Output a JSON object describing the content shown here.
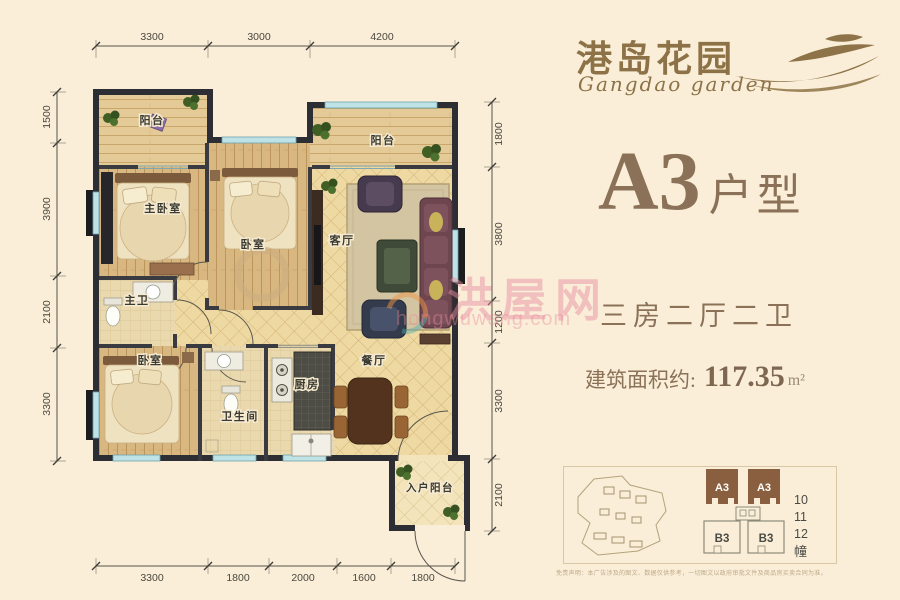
{
  "logo": {
    "cn": "港岛花园",
    "en": "Gangdao garden"
  },
  "unit": {
    "code": "A3",
    "type_suffix": "户型",
    "rooms_desc": "三房二厅二卫",
    "area_label": "建筑面积约:",
    "area_value": "117.35",
    "area_unit": "m²"
  },
  "floorplan": {
    "rooms": [
      {
        "label": "阳台"
      },
      {
        "label": "主卧室"
      },
      {
        "label": "卧室"
      },
      {
        "label": "阳台"
      },
      {
        "label": "客厅"
      },
      {
        "label": "主卫"
      },
      {
        "label": "卧室"
      },
      {
        "label": "卫生间"
      },
      {
        "label": "厨房"
      },
      {
        "label": "餐厅"
      },
      {
        "label": "入户阳台"
      }
    ],
    "dim_top": [
      "3300",
      "3000",
      "4200"
    ],
    "dim_left": [
      "1500",
      "3900",
      "2100",
      "3300"
    ],
    "dim_right": [
      "1800",
      "3800",
      "1200",
      "3300",
      "2100"
    ],
    "dim_bottom": [
      "3300",
      "1800",
      "2000",
      "1600",
      "1800"
    ]
  },
  "watermark": {
    "cn": "洪屋网",
    "en": "hongwuwang.com"
  },
  "sitemap": {
    "towers_top": [
      "A3",
      "A3"
    ],
    "towers_bottom": [
      "B3",
      "B3"
    ],
    "numbers": [
      "10",
      "11",
      "12"
    ],
    "unit_suffix": "幢"
  },
  "disclaimer": "免责声明：本广告涉及的图文、数据仅供参考，一切图文以政府审批文件及商品房买卖合同为准。",
  "colors": {
    "background": "#faeed8",
    "brand_brown": "#8c7246",
    "title_brown": "#8a7158",
    "wall": "#2d2e33",
    "tower_block": "#8a5f3f",
    "watermark_pink": "#e98ca0",
    "window_teal": "#bfe2e6"
  }
}
